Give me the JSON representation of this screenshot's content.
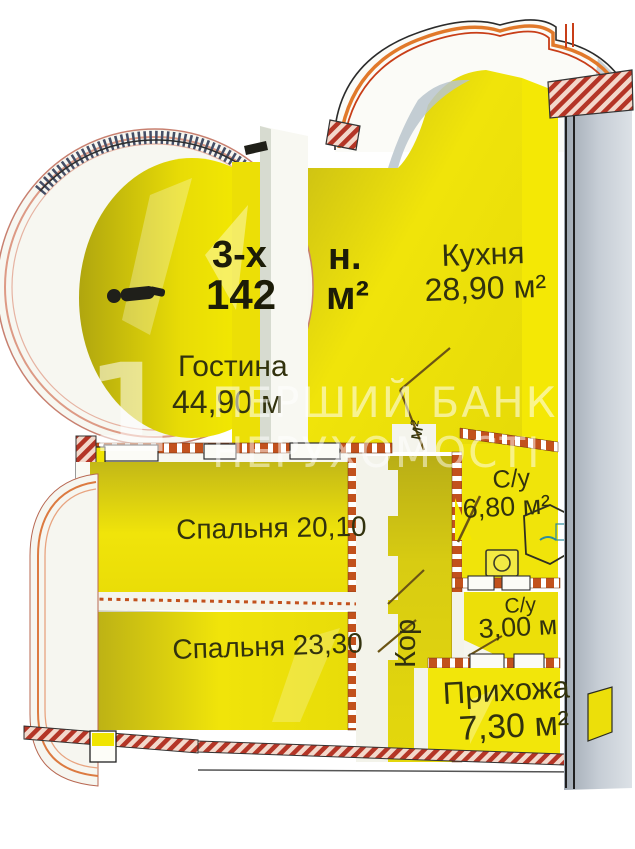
{
  "watermark": {
    "logo_digit": "1",
    "line1": "ПЕРШИЙ БАНК",
    "line2": "НЕРУХОМОСТІ"
  },
  "plan": {
    "title": {
      "line1_left": "3-х",
      "line1_right": "н.",
      "line2_left": "142",
      "line2_right": "м²"
    },
    "rooms": {
      "kitchen": {
        "name": "Кухня",
        "area": "28,90 м²"
      },
      "living": {
        "name": "Гостина",
        "area": "44,90 м"
      },
      "bedroom1": {
        "label": "Спальня 20,10"
      },
      "bedroom2": {
        "label": "Спальня 23,30"
      },
      "bathroom1": {
        "name": "С/у",
        "area": "6,80 м²"
      },
      "bathroom2": {
        "name": "С/у",
        "area": "3,00 м"
      },
      "hallway": {
        "name": "Прихожа",
        "area": "7,30 м²"
      },
      "corridor": {
        "name": "Кор",
        "unit": "м²"
      }
    }
  },
  "colors": {
    "floor_bright": "#f2e70b",
    "floor_olive": "#b8ae1b",
    "wall_white": "#f6f6f0",
    "hatch_red": "#b43526",
    "dash_orange": "#c2511d",
    "exterior_grey": "#c6cdd5",
    "text_dark": "#32320e",
    "watermark_white": "rgba(255,255,255,0.55)"
  }
}
